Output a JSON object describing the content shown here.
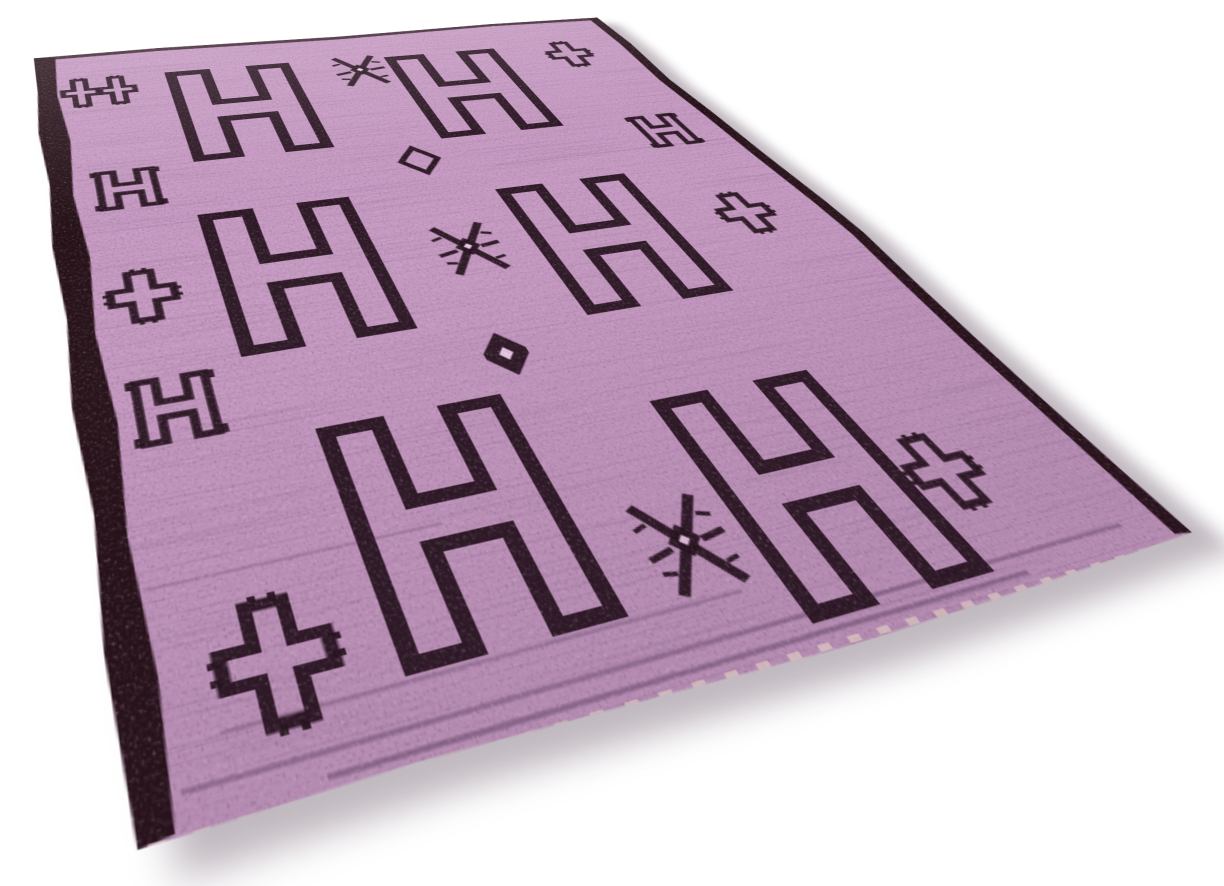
{
  "scene": {
    "description": "Angled product photograph of a handwoven pink-purple kilim rug with black geometric tribal motifs, lying on a plain white background",
    "background_color": "#ffffff"
  },
  "rug": {
    "canvas": {
      "width": 620,
      "height": 806
    },
    "colors": {
      "field": "#c79bc3",
      "field_light": "#eccde8",
      "field_dark": "#5c3f5e",
      "motif": "#23101a",
      "border": "#241016",
      "fringe": "#e9dcc6"
    },
    "motif_legend": {
      "large-h": "large outlined letter-H motif",
      "small-h": "small outlined H motif with serif hooks",
      "cross": "stepped plus / cross motif with toothed arm tips",
      "double-cross": "two linked stepped crosses",
      "x-star": "eight-legged spider star motif with solid diamond center",
      "diamond-small": "small stepped diamond outline",
      "diamond-stepped": "solid stepped lozenge with light center",
      "plus-big": "large toothed plus motif"
    },
    "motifs": [
      {
        "type": "double-cross",
        "x": 57,
        "y": 88
      },
      {
        "type": "x-star",
        "x": 300,
        "y": 89
      },
      {
        "type": "cross",
        "x": 523,
        "y": 92
      },
      {
        "type": "large-h",
        "x": 177,
        "y": 148
      },
      {
        "type": "large-h",
        "x": 390,
        "y": 153
      },
      {
        "type": "small-h",
        "x": 63,
        "y": 268
      },
      {
        "type": "diamond-small",
        "x": 300,
        "y": 275
      },
      {
        "type": "small-h",
        "x": 538,
        "y": 270
      },
      {
        "type": "large-h",
        "x": 167,
        "y": 409
      },
      {
        "type": "x-star",
        "x": 294,
        "y": 412
      },
      {
        "type": "large-h",
        "x": 404,
        "y": 425
      },
      {
        "type": "cross",
        "x": 57,
        "y": 415
      },
      {
        "type": "cross",
        "x": 533,
        "y": 418
      },
      {
        "type": "small-h",
        "x": 62,
        "y": 535
      },
      {
        "type": "diamond-stepped",
        "x": 274,
        "y": 539
      },
      {
        "type": "large-h",
        "x": 196,
        "y": 665
      },
      {
        "type": "large-h",
        "x": 403,
        "y": 697
      },
      {
        "type": "x-star",
        "x": 308,
        "y": 718
      },
      {
        "type": "cross",
        "x": 488,
        "y": 713
      },
      {
        "type": "plus-big",
        "x": 82,
        "y": 727
      }
    ]
  }
}
